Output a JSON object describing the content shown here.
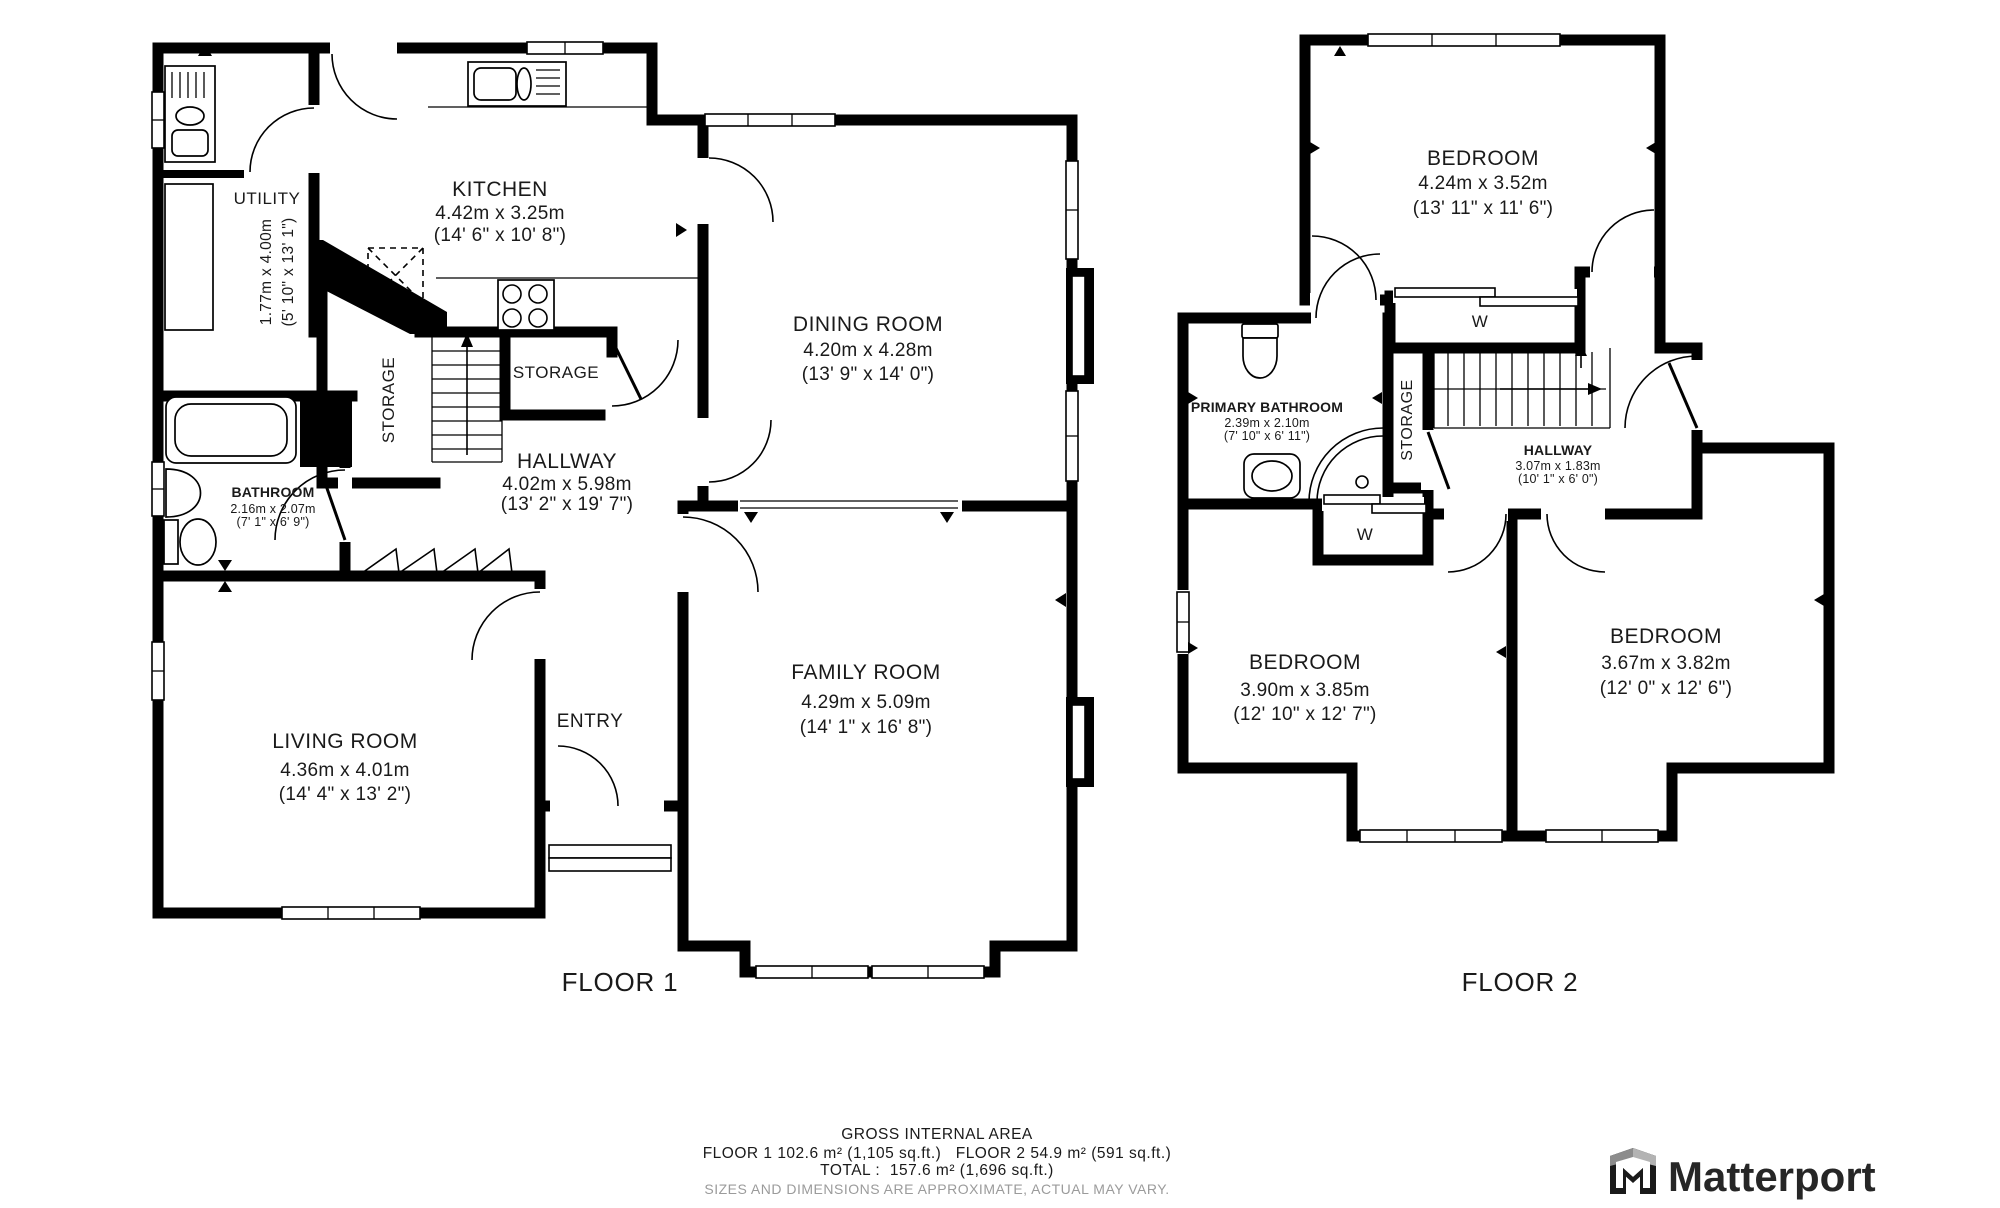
{
  "floor1": {
    "label": "FLOOR 1",
    "rooms": {
      "utility": {
        "name": "UTILITY",
        "dims_m": "1.77m x 4.00m",
        "dims_ft": "(5' 10\" x 13' 1\")"
      },
      "kitchen": {
        "name": "KITCHEN",
        "dims_m": "4.42m x 3.25m",
        "dims_ft": "(14' 6\" x 10' 8\")"
      },
      "dining": {
        "name": "DINING ROOM",
        "dims_m": "4.20m x 4.28m",
        "dims_ft": "(13' 9\" x 14' 0\")"
      },
      "storage_left": {
        "name": "STORAGE"
      },
      "storage_right": {
        "name": "STORAGE"
      },
      "hallway": {
        "name": "HALLWAY",
        "dims_m": "4.02m x 5.98m",
        "dims_ft": "(13' 2\" x 19' 7\")"
      },
      "bathroom": {
        "name": "BATHROOM",
        "dims_m": "2.16m x 2.07m",
        "dims_ft": "(7' 1\" x 6' 9\")"
      },
      "living": {
        "name": "LIVING ROOM",
        "dims_m": "4.36m x 4.01m",
        "dims_ft": "(14' 4\" x 13' 2\")"
      },
      "entry": {
        "name": "ENTRY"
      },
      "family": {
        "name": "FAMILY ROOM",
        "dims_m": "4.29m x 5.09m",
        "dims_ft": "(14' 1\" x 16' 8\")"
      }
    }
  },
  "floor2": {
    "label": "FLOOR 2",
    "rooms": {
      "bedroom_top": {
        "name": "BEDROOM",
        "dims_m": "4.24m x 3.52m",
        "dims_ft": "(13' 11\" x 11' 6\")"
      },
      "primary_bathroom": {
        "name": "PRIMARY BATHROOM",
        "dims_m": "2.39m x 2.10m",
        "dims_ft": "(7' 10\" x 6' 11\")"
      },
      "storage": {
        "name": "STORAGE"
      },
      "hallway": {
        "name": "HALLWAY",
        "dims_m": "3.07m x 1.83m",
        "dims_ft": "(10' 1\" x 6' 0\")"
      },
      "closet_top": {
        "name": "W"
      },
      "closet_left": {
        "name": "W"
      },
      "bedroom_left": {
        "name": "BEDROOM",
        "dims_m": "3.90m x 3.85m",
        "dims_ft": "(12' 10\" x 12' 7\")"
      },
      "bedroom_right": {
        "name": "BEDROOM",
        "dims_m": "3.67m x 3.82m",
        "dims_ft": "(12' 0\" x 12' 6\")"
      }
    }
  },
  "footer": {
    "title": "GROSS INTERNAL AREA",
    "areas_line": "FLOOR 1 102.6 m² (1,105 sq.ft.)   FLOOR 2 54.9 m² (591 sq.ft.)",
    "total_line": "TOTAL :  157.6 m² (1,696 sq.ft.)",
    "disclaimer": "SIZES AND DIMENSIONS ARE APPROXIMATE, ACTUAL MAY VARY."
  },
  "branding": {
    "logo_text": "Matterport"
  },
  "colors": {
    "wall": "#000000",
    "label": "#1a1a1a",
    "disclaimer": "#9b9b9b",
    "logo": "#262626",
    "background": "#ffffff"
  }
}
